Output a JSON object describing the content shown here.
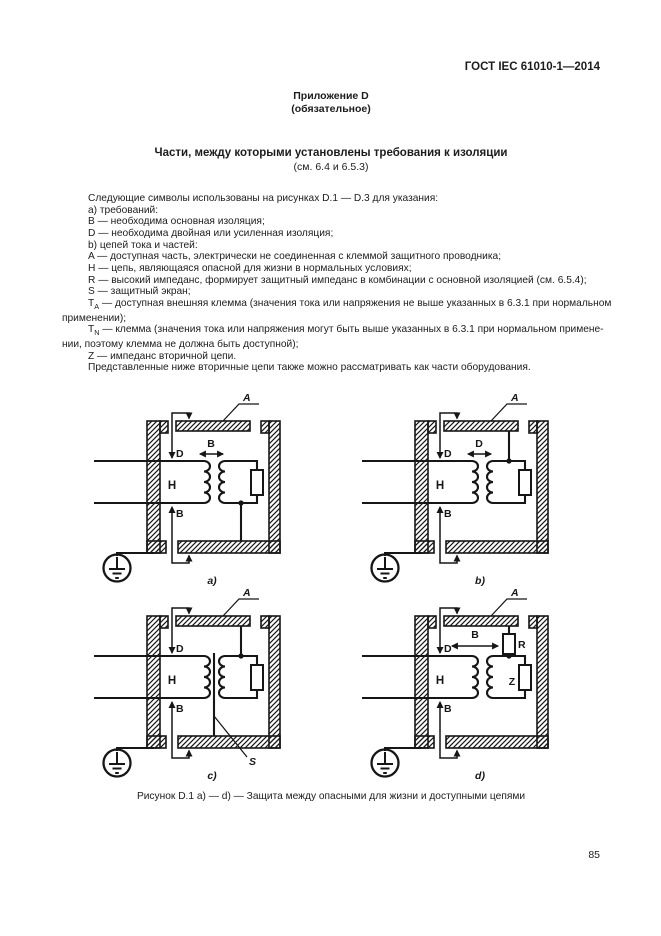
{
  "page": {
    "header": "ГОСТ IEC 61010-1—2014",
    "annex": {
      "line1": "Приложение D",
      "line2": "(обязательное)"
    },
    "title": "Части, между которыми установлены требования к изоляции",
    "title_ref": "(см. 6.4 и 6.5.3)",
    "page_number": "85"
  },
  "body": {
    "lines": [
      {
        "text": "Следующие символы использованы на рисунках D.1 — D.3 для указания:"
      },
      {
        "text": "a) требований:"
      },
      {
        "text": "B — необходима основная изоляция;"
      },
      {
        "text": "D — необходима двойная или усиленная изоляция;"
      },
      {
        "text": "b) цепей тока и частей:"
      },
      {
        "text": "A — доступная часть, электрически не соединенная с клеммой защитного проводника;"
      },
      {
        "text": "H — цепь, являющаяся опасной для жизни в нормальных условиях;"
      },
      {
        "text": "R — высокий импеданс, формирует защитный импеданс в комбинации с основной изоляцией (см. 6.5.4);"
      },
      {
        "text": "S — защитный экран;"
      },
      {
        "pre": "T",
        "sub": "A",
        "text": " — доступная внешняя клемма (значения тока или напряжения не выше указанных в 6.3.1 при нормальном"
      },
      {
        "text": "применении);"
      },
      {
        "pre": "T",
        "sub": "N",
        "text": " — клемма (значения тока или напряжения могут быть выше указанных в 6.3.1 при нормальном примене-"
      },
      {
        "text": "нии, поэтому клемма не должна быть доступной);"
      },
      {
        "text": "Z — импеданс вторичной цепи."
      },
      {
        "text": "Представленные ниже вторичные цепи также можно рассматривать как части оборудования."
      }
    ]
  },
  "figure": {
    "caption": "Рисунок D.1 a) — d) — Защита между опасными для жизни и доступными цепями",
    "a": {
      "label": "a)",
      "enclosure": "A",
      "top_ins": "D",
      "bottom_ins": "B",
      "mid": "B",
      "hazard": "H"
    },
    "b": {
      "label": "b)",
      "enclosure": "A",
      "top_ins": "D",
      "bottom_ins": "B",
      "mid": "D",
      "hazard": "H"
    },
    "c": {
      "label": "c)",
      "enclosure": "A",
      "top_ins": "D",
      "bottom_ins": "B",
      "screen": "S",
      "hazard": "H"
    },
    "d": {
      "label": "d)",
      "enclosure": "A",
      "top_ins": "D",
      "bottom_ins": "B",
      "mid": "B",
      "hazard": "H",
      "resistor": "R",
      "impedance": "Z"
    }
  }
}
